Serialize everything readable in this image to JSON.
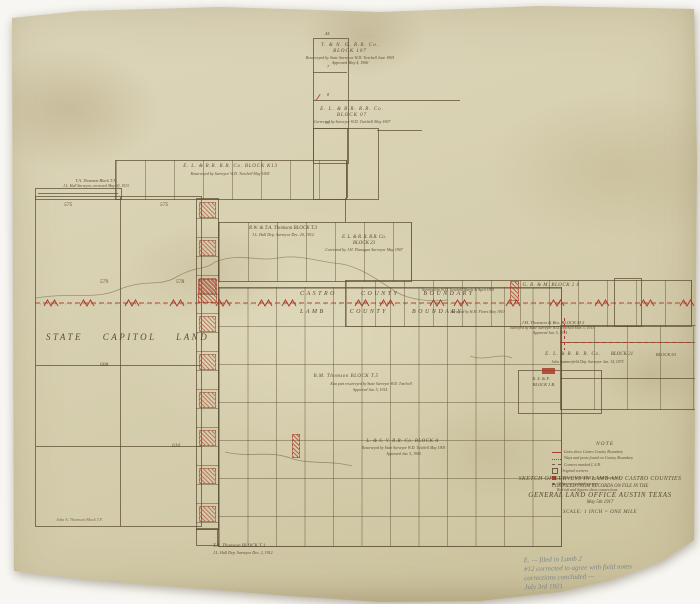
{
  "palette": {
    "paper": "#d8d1b2",
    "ink": "#5f5036",
    "red": "#a93d28",
    "pencil": "#767e8a"
  },
  "map": {
    "capitol_label": "STATE CAPITOL LAND",
    "blocks": {
      "tno107": {
        "name": "T. & N. O. R.R. Co.",
        "block": "BLOCK 107",
        "sub1": "Resurveyed by State Surveyor W.D. Twichell June 1905",
        "sub2": "Approved May 4, 1906"
      },
      "el07": {
        "name": "E. L. & R.R. R.R. Co.",
        "block": "BLOCK 07",
        "sub1": "Corrected by Surveyor W.D. Twichell May 1907"
      },
      "k13": {
        "name": "E. L. & R.R. R.R. Co.   BLOCK K13",
        "sub1": "Resurveyed by Surveyor W.D. Twichell May 1905"
      },
      "thomson_ta": {
        "name": "T.A. Thomson Block T.A.",
        "sub1": "J.L. Hall Surveyor, corrected May 20, 1913"
      },
      "t3": {
        "name": "R.W. & T.A. Thomson   BLOCK T.3",
        "sub1": "J.L. Hall Dep. Surveyor Dec. 20, 1912"
      },
      "el23": {
        "name": "E. L. & R. R. R.R. Co.",
        "block": "BLOCK 23",
        "sub1": "Corrected by J.H. Flanagan Surveyor May 1907"
      },
      "gbm2s": {
        "name": "G. B. & M.   BLOCK 2 S",
        "sub1": "Surveyed by W.D. Twichell March & April 1905",
        "sub2": "Surveyed by H.M. Flores May 1910"
      },
      "m2": {
        "name": "J.H. Thomson & Bro.   BLOCK M 2",
        "sub1": "Surveyed by State Surveyor W.D. Twichell Mar. 3, 1913",
        "sub2": "Approved Jan. 5, 1914"
      },
      "el21": {
        "name": "E. L. & R. R. R. Co.",
        "block": "BLOCK 21",
        "sub1": "John Summerfield Dep. Surveyor Jan. 14, 1875"
      },
      "blk63": {
        "name": "BLOCK 63"
      },
      "jb": {
        "name": "B. S. & F.",
        "block": "BLOCK J.B."
      },
      "t5": {
        "name": "B.M. Thomson   BLOCK T.5",
        "sub1": "East part resurveyed by State Surveyor W.D. Twichell",
        "sub2": "Approved Jan. 5, 1914"
      },
      "blockA": {
        "name": "L. & S. V. R.R. Co.   BLOCK A",
        "sub1": "Resurveyed by State Surveyor W.D. Twichell May 1905",
        "sub2": "Approved Jan. 5, 1906"
      },
      "t1": {
        "name": "T.A. Thomson   BLOCK T.1",
        "sub1": "J.L. Hall Dep. Surveyor Dec. 2, 1912"
      },
      "tf": {
        "name": "John A. Thomson   Block T.F."
      }
    },
    "boundary": {
      "castro_label": "CASTRO COUNTY BOUNDARY",
      "lamb_label": "LAMB COUNTY BOUNDARY"
    },
    "numbers": {
      "capitol": [
        "575",
        "575",
        "579",
        "578",
        "608",
        "616"
      ],
      "top_strip": [
        "44",
        "7",
        "8",
        "10"
      ]
    }
  },
  "note": {
    "heading": "NOTE",
    "items": [
      {
        "marker": "red-line",
        "text": "Lines show Castro County Boundary"
      },
      {
        "marker": "red-zigzag",
        "text": "Ways and posts found on County Boundary"
      },
      {
        "marker": "ink-dash",
        "text": "Corners marked L.S.B."
      },
      {
        "marker": "square",
        "text": "Original corners"
      },
      {
        "marker": "red-square",
        "text": "Corners established by State Surveyor"
      },
      {
        "marker": "dot",
        "text": "Other recognized corners"
      },
      {
        "marker": "none",
        "text": "Red ink and figures show connections"
      }
    ]
  },
  "title_block": {
    "line1": "SKETCH OF SURVEYS IN LAMB AND CASTRO COUNTIES",
    "line2": "COMPILED FROM RECORDS ON FILE IN THE",
    "line3": "GENERAL LAND OFFICE AUSTIN TEXAS",
    "line4": "May 5th 1917",
    "scale": "SCALE: 1 INCH = ONE MILE"
  },
  "handwriting": {
    "lines": [
      "E. — filed in Lamb 2",
      "#12 corrected to agree with field notes",
      "corrections concluded —",
      "July 3rd 1921"
    ]
  }
}
